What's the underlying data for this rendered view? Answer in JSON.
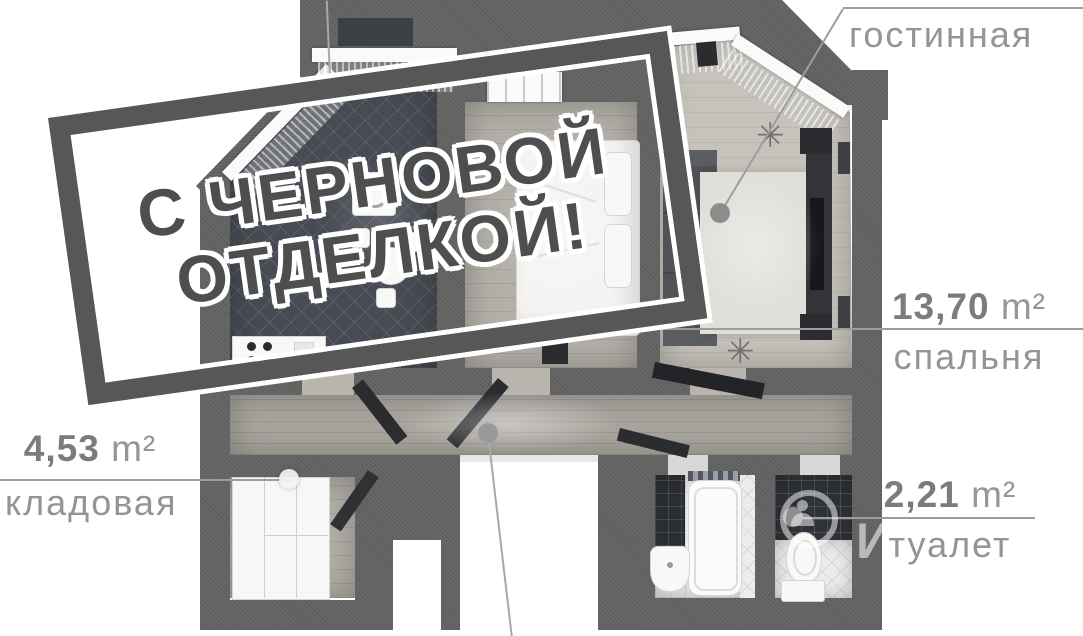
{
  "stamp": {
    "line1": "С ЧЕРНОВОЙ",
    "line2": "ОТДЕЛКОЙ!"
  },
  "labels": {
    "living": {
      "name": "гостинная"
    },
    "bedroom": {
      "area": "13,70",
      "unit": "m²",
      "name": "спальня"
    },
    "storage": {
      "area": "4,53",
      "unit": "m²",
      "name": "кладовая"
    },
    "toilet": {
      "area": "2,21",
      "unit": "m²",
      "name": "туалет"
    }
  },
  "watermark": {
    "letter": "И"
  },
  "colors": {
    "wall": "#636363",
    "label_text": "#939393",
    "label_number": "#7c7c7c",
    "stamp_ink": "#4e4e4e",
    "leader_line": "#9d9d9d"
  }
}
